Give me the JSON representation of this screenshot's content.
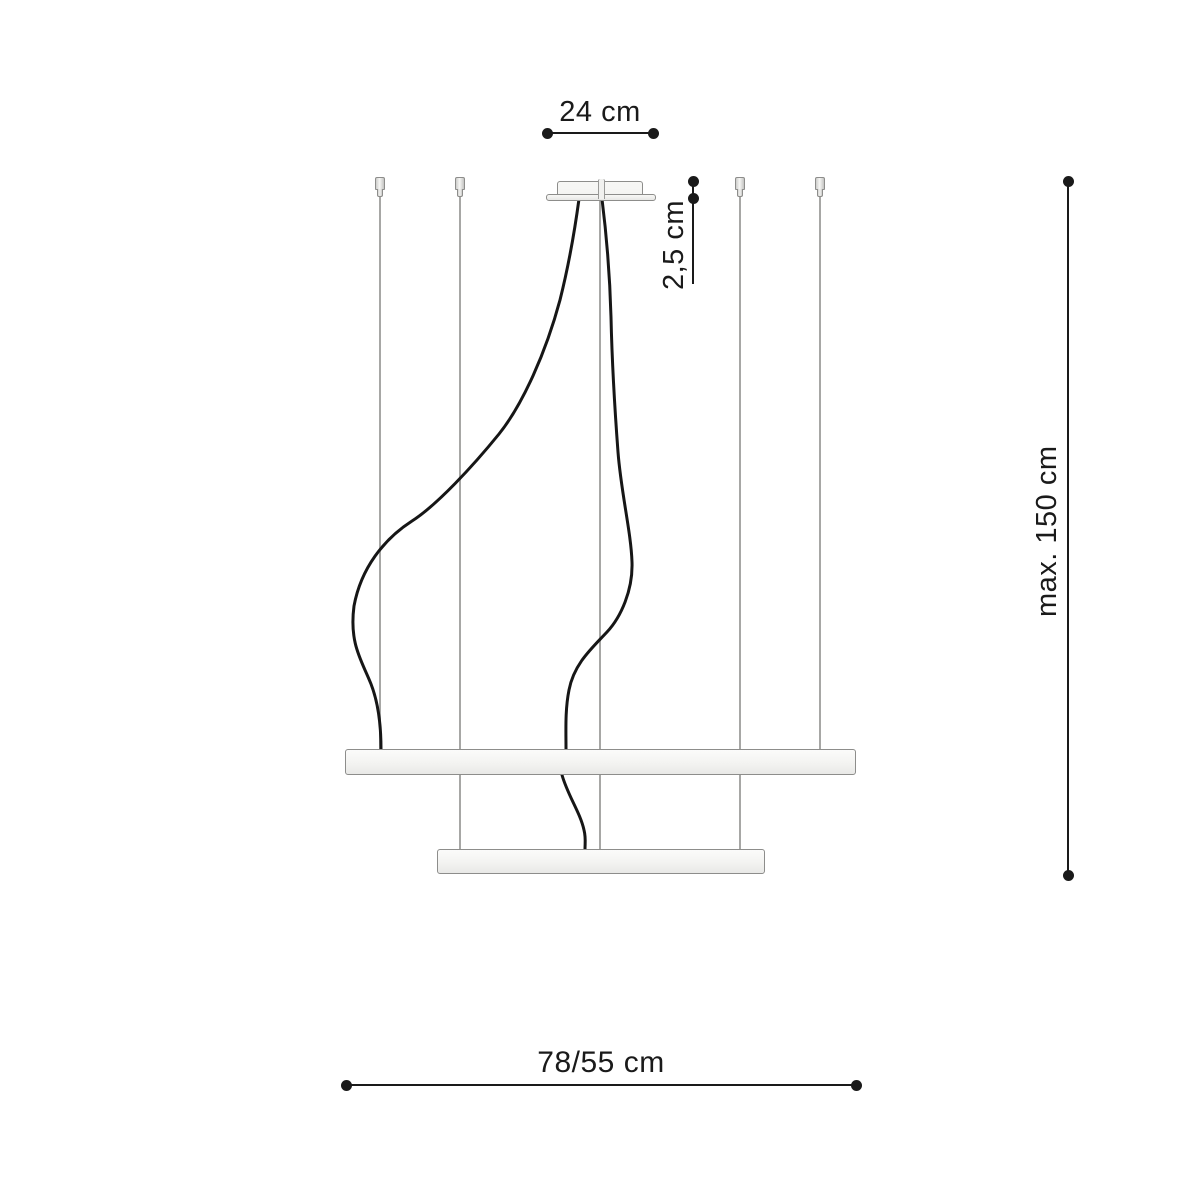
{
  "diagram": {
    "dimensions": {
      "canopy_width": "24 cm",
      "canopy_height": "2,5 cm",
      "suspension_max": "max. 150 cm",
      "ring_diameters": "78/55 cm"
    },
    "colors": {
      "ink": "#1a1a1a",
      "wire": "#a7a7a5",
      "cable": "#161616",
      "fixture_fill": "#f4f4f2",
      "fixture_fill_dark": "#e9e9e7",
      "fixture_edge": "#8d8d8b",
      "background": "#ffffff"
    }
  }
}
